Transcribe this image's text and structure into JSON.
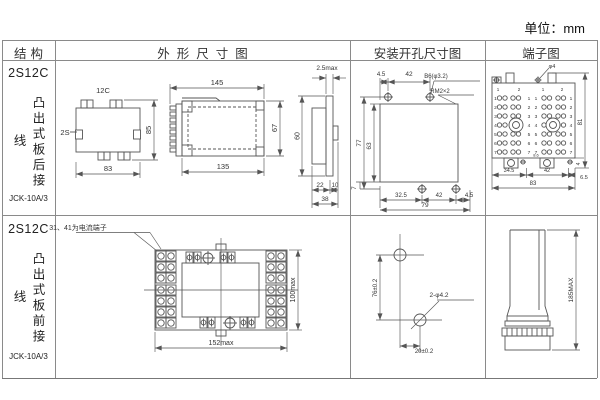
{
  "page": {
    "unit": "单位：mm"
  },
  "headers": {
    "structure": "结构",
    "outline": "外形尺寸图",
    "install": "安装开孔尺寸图",
    "terminal": "端子图"
  },
  "row1": {
    "model": "2S12C",
    "wiring": "凸出式板后接线",
    "type": "JCK-10A/3",
    "rear": {
      "top_label": "12C",
      "left_label": "2S",
      "height": "85",
      "width": "83"
    },
    "side": {
      "top": "145",
      "bottom": "135",
      "height": "67"
    },
    "panel": {
      "top": "2.5max",
      "height": "60",
      "d1": "22",
      "d2": "10",
      "d3": "38"
    },
    "install": {
      "t1": "4.5",
      "t2": "42",
      "hole": "B6(φ3.2)",
      "thread": "RM2×2",
      "h1": "77",
      "h2": "63",
      "b0": "7",
      "b1": "32.5",
      "b2": "42",
      "b3": "4.5",
      "b4": "79"
    },
    "terminal": {
      "screw": "φ4",
      "height": "81",
      "gap": "8.6",
      "foot": "4",
      "b1": "34.5",
      "b2": "42",
      "b3": "6.5",
      "b4": "83",
      "top_nums": [
        "1",
        "2",
        "1",
        "2"
      ],
      "rows": [
        "1",
        "2",
        "3",
        "4",
        "5",
        "6",
        "7"
      ]
    }
  },
  "row2": {
    "model": "2S12C",
    "wiring": "凸出式板前接线",
    "type": "JCK-10A/3",
    "front": {
      "note": "31、41为电流端子",
      "width": "152max",
      "height": "100max"
    },
    "install": {
      "v": "76±0.2",
      "h": "20±0.2",
      "hole": "2-φ4.2"
    },
    "side": {
      "height": "185MAX"
    }
  }
}
